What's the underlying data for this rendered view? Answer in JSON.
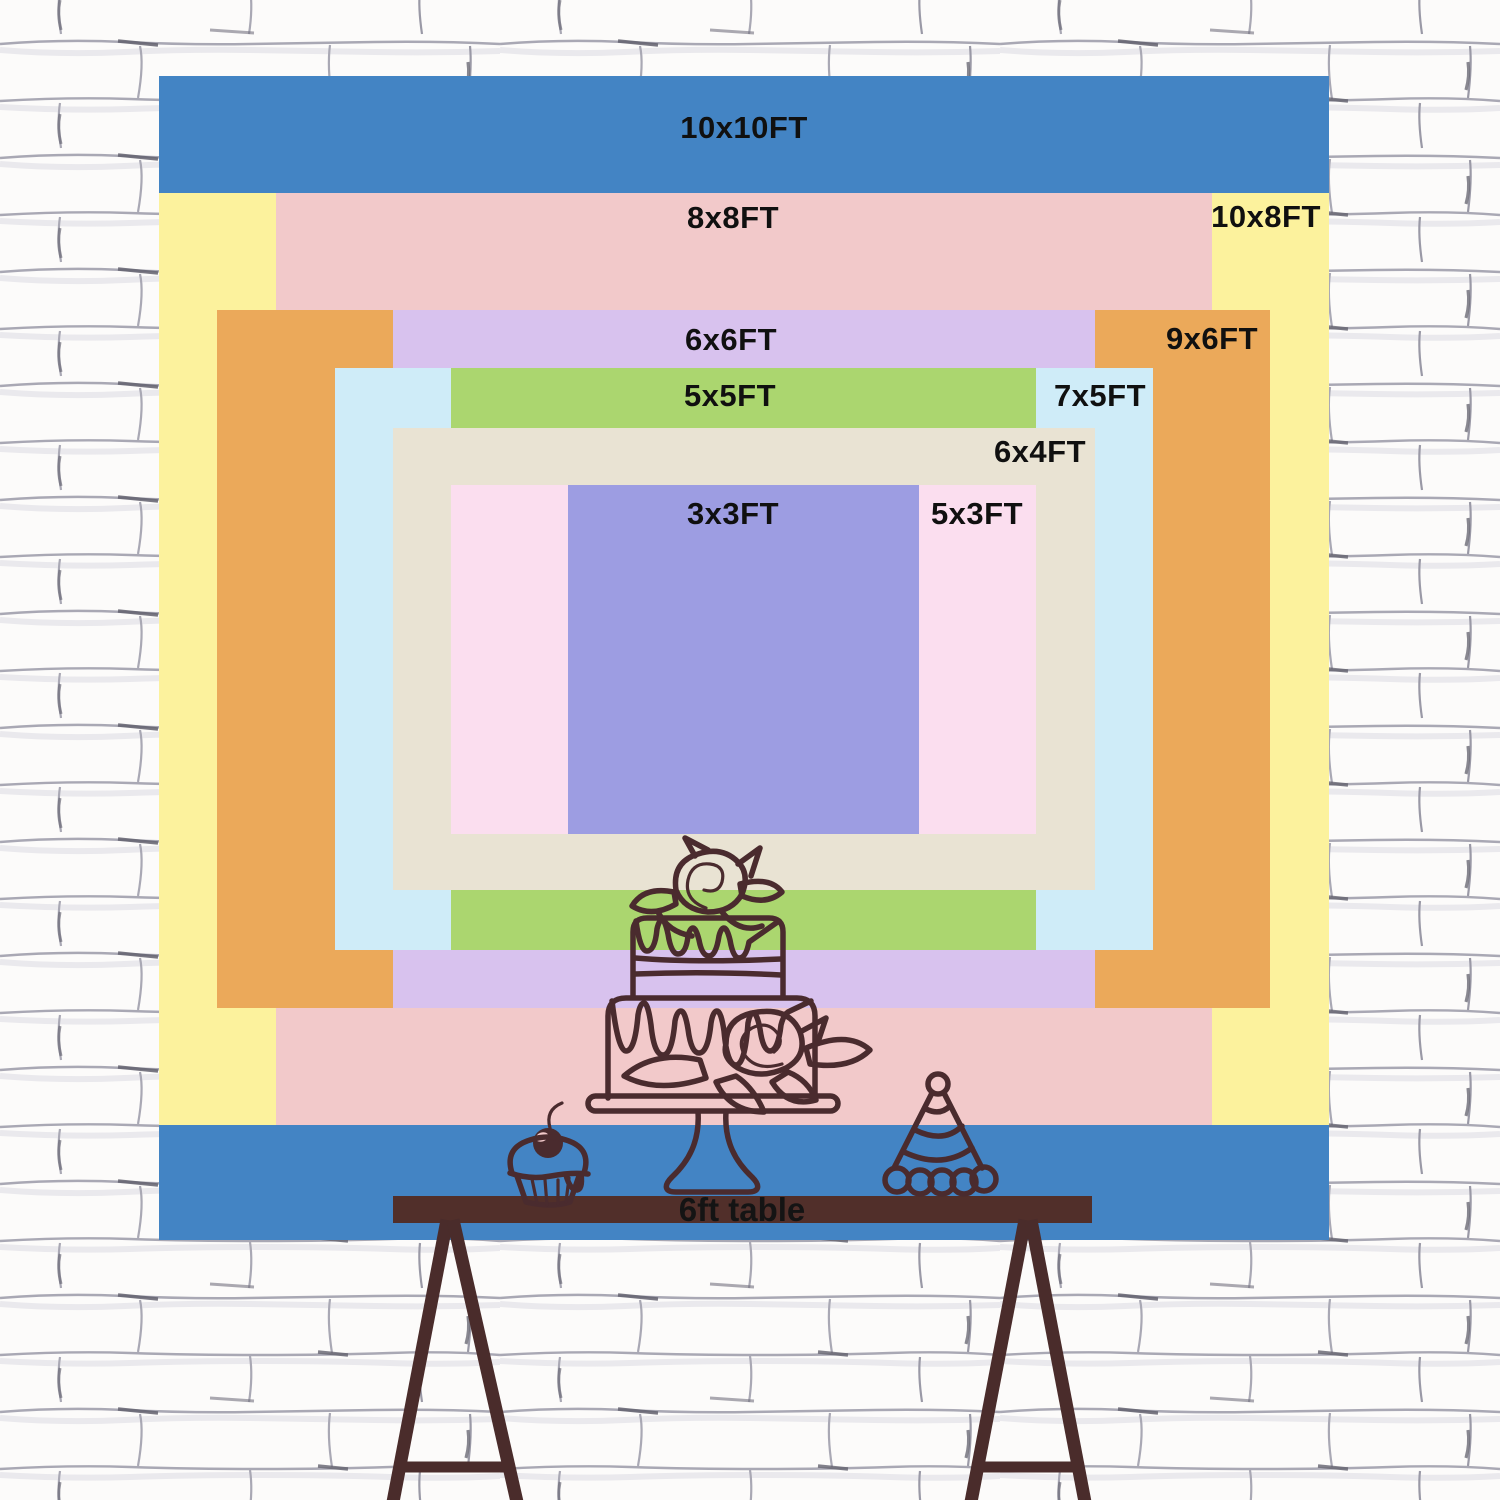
{
  "scene": {
    "background": "white painted brick wall",
    "props": [
      "two-tier-cake-on-stand",
      "cupcake-with-cherry",
      "party-hat"
    ]
  },
  "chart_data": {
    "type": "nested-size-comparison",
    "unit": "FT",
    "legend_position": "inside-top of each rectangle",
    "sizes": [
      {
        "label": "10x10FT",
        "width_ft": 10,
        "height_ft": 10,
        "color": "#4384c4"
      },
      {
        "label": "10x8FT",
        "width_ft": 10,
        "height_ft": 8,
        "color": "#fcf29d"
      },
      {
        "label": "8x8FT",
        "width_ft": 8,
        "height_ft": 8,
        "color": "#f2c9ca"
      },
      {
        "label": "9x6FT",
        "width_ft": 9,
        "height_ft": 6,
        "color": "#eba95a"
      },
      {
        "label": "6x6FT",
        "width_ft": 6,
        "height_ft": 6,
        "color": "#d8c2ee"
      },
      {
        "label": "7x5FT",
        "width_ft": 7,
        "height_ft": 5,
        "color": "#cfecf8"
      },
      {
        "label": "5x5FT",
        "width_ft": 5,
        "height_ft": 5,
        "color": "#abd66f"
      },
      {
        "label": "6x4FT",
        "width_ft": 6,
        "height_ft": 4,
        "color": "#e9e3d3"
      },
      {
        "label": "5x3FT",
        "width_ft": 5,
        "height_ft": 3,
        "color": "#fbdeef"
      },
      {
        "label": "3x3FT",
        "width_ft": 3,
        "height_ft": 3,
        "color": "#9d9de2"
      }
    ],
    "label_color": "#101010"
  },
  "table": {
    "label": "6ft table",
    "color": "#512f2a",
    "leg_color": "#4a2c2b"
  },
  "line_art_color": "#4a2b2e",
  "wall_line_color": "#a9a8b4"
}
